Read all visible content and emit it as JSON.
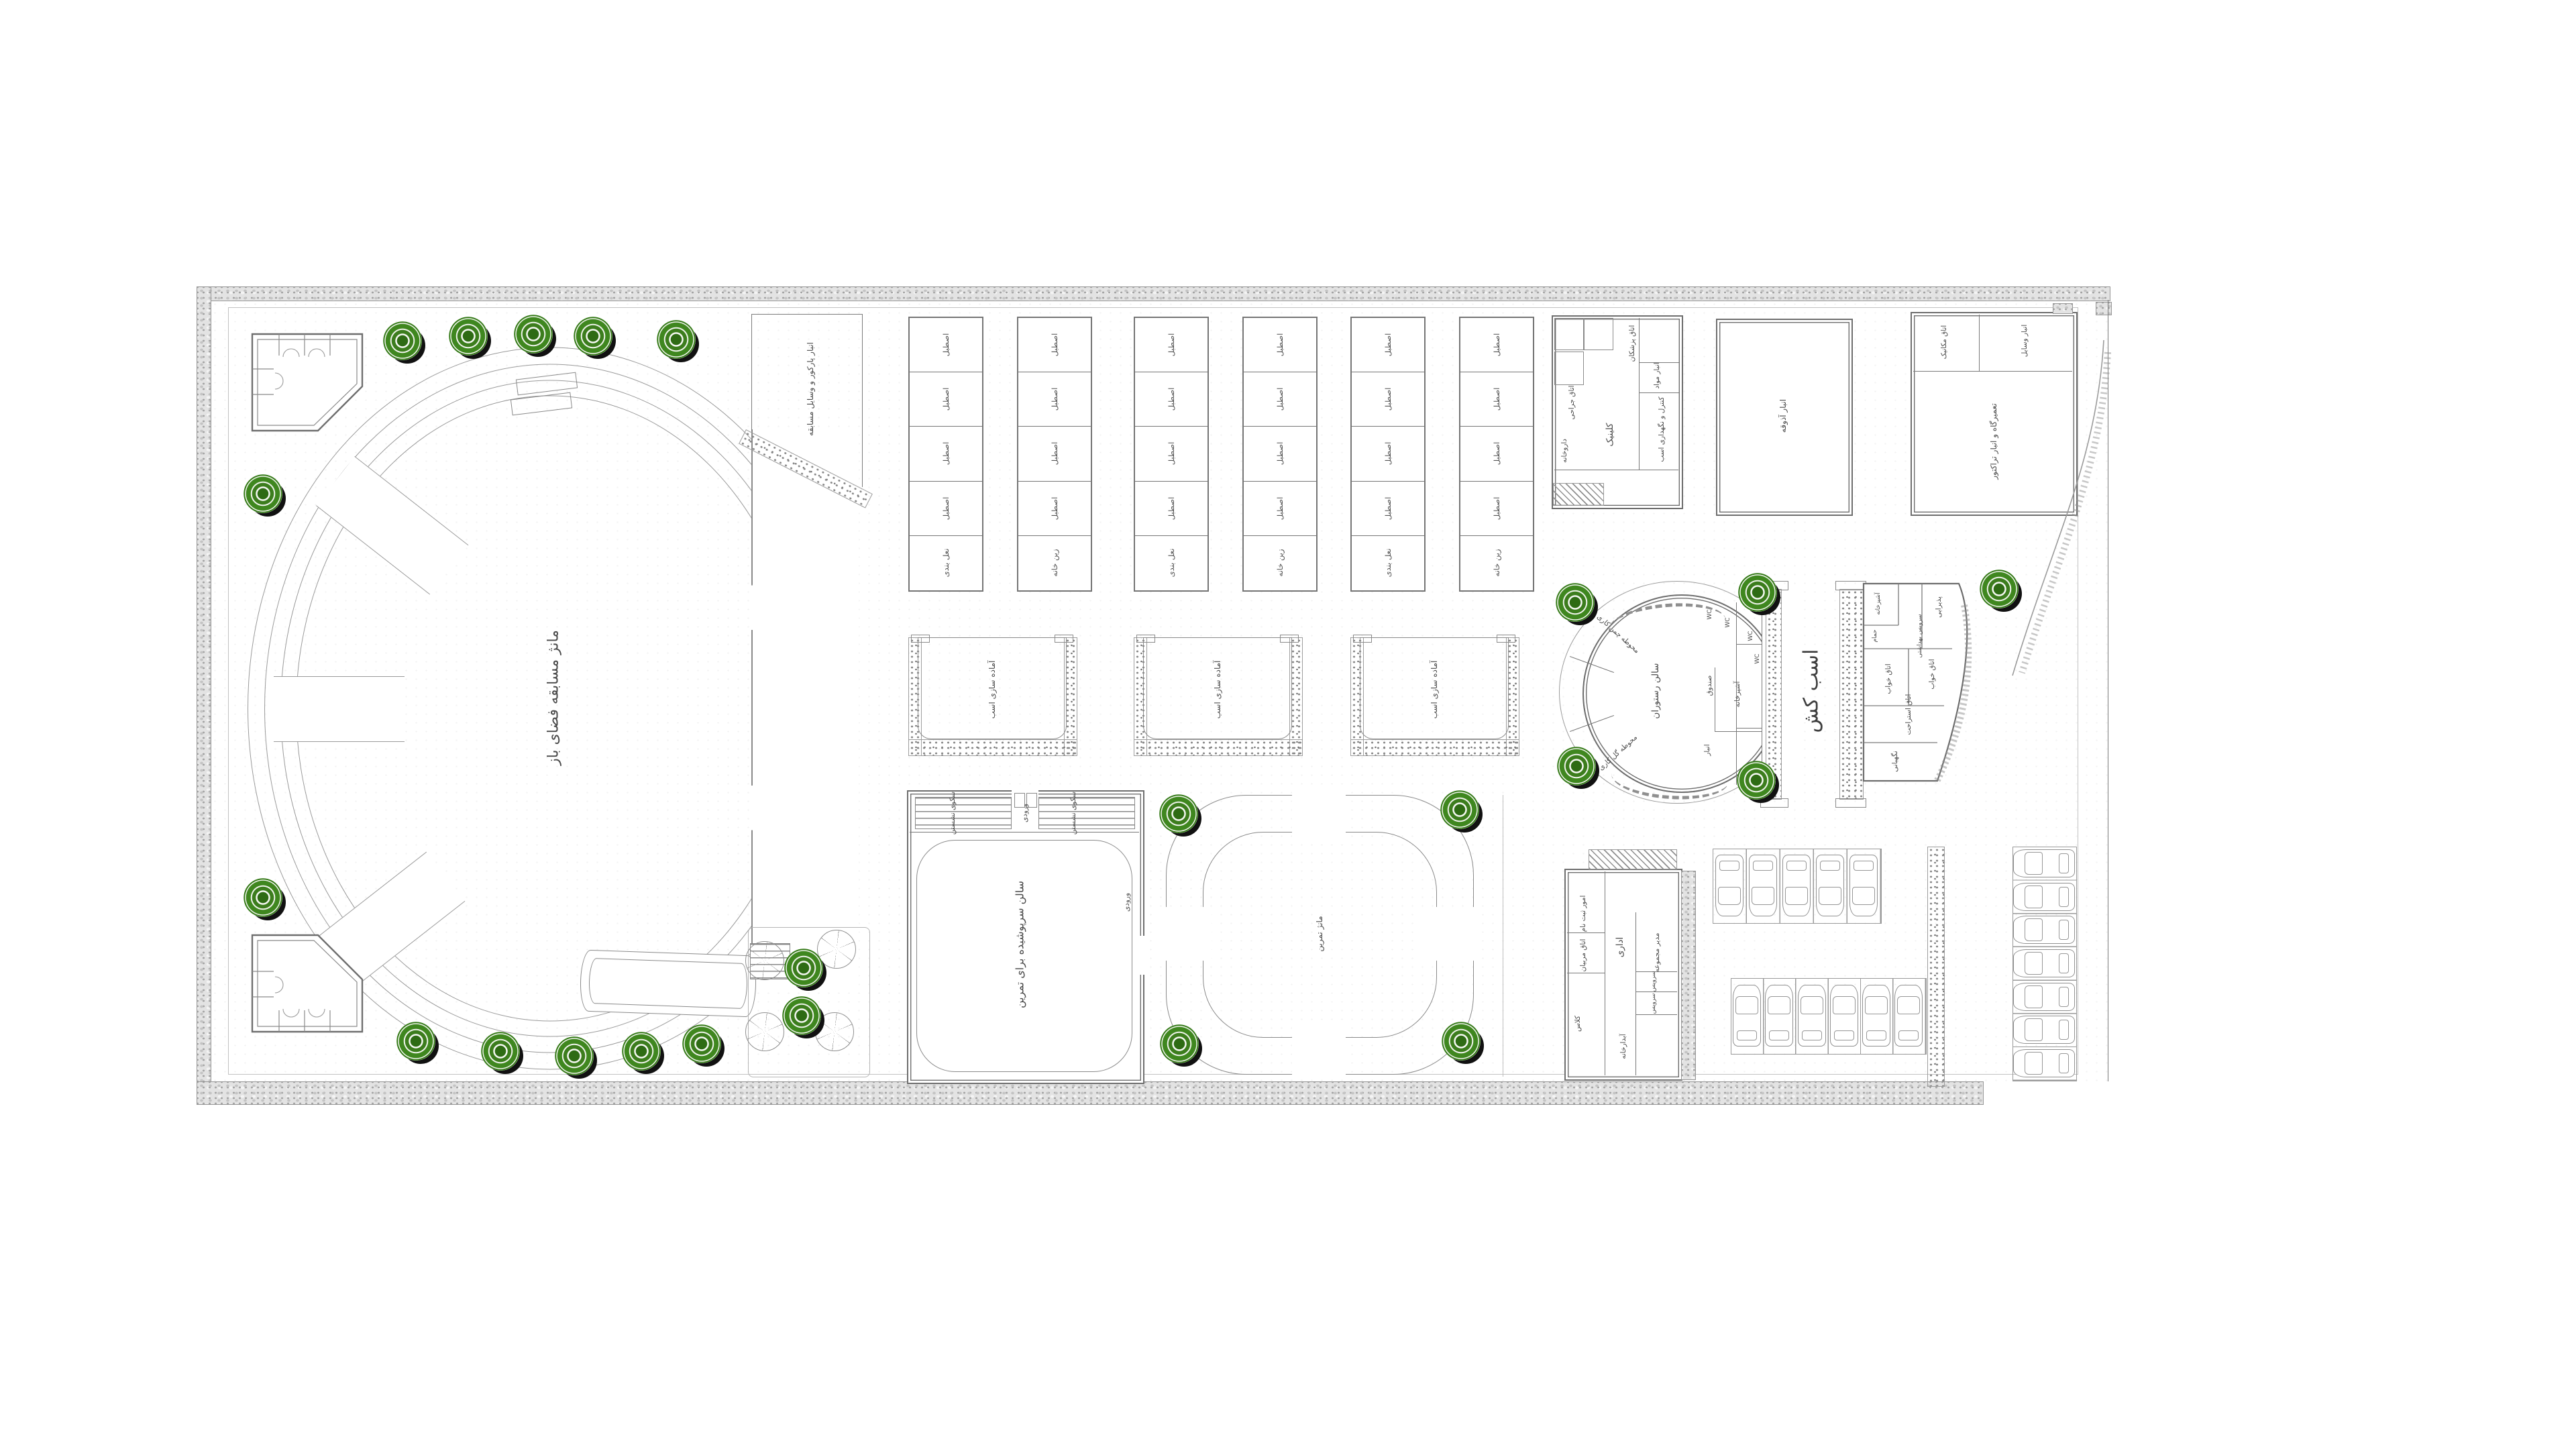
{
  "colors": {
    "tree": "#3b7d1c",
    "tree_shadow": "#111111",
    "wall": "#6e6e6e",
    "line": "#8a8a8a",
    "gravel": "#e3e3e3",
    "text": "#4a4a4a",
    "background": "#ffffff"
  },
  "plan": {
    "stadium": {
      "label": "مانژ مسابقه فضای باز"
    },
    "obstacle_store": {
      "label": "انبار پارکور و وسایل مسابقه"
    },
    "stables": {
      "blocks": 3,
      "left_labels": [
        "اصطبل",
        "اصطبل",
        "اصطبل",
        "اصطبل",
        "نعل بندی"
      ],
      "right_labels": [
        "اصطبل",
        "اصطبل",
        "اصطبل",
        "اصطبل",
        "زین خانه"
      ]
    },
    "paddocks": {
      "count": 3,
      "label": "آماده سازی اسب"
    },
    "hall": {
      "label": "سالن سرپوشیده برای تمرین",
      "entrance": "ورودی",
      "seating": "سکوی نشستن"
    },
    "ring": {
      "label": "مانژ تمرین"
    },
    "clinic": {
      "name": "کلینیک",
      "rooms": [
        "اتاق جراحی",
        "داروخانه",
        "اتاق پزشکان",
        "انبار مواد",
        "کنترل و نگهداری اسب"
      ]
    },
    "feed": {
      "label": "انبار آذوقه"
    },
    "workshop": {
      "label": "تعمیرگاه و انبار تراکتور",
      "rooms": [
        "اتاق مکانیک",
        "انبار وسایل"
      ]
    },
    "restaurant": {
      "hall": "سالن رستوران",
      "kitchen": "آشپزخانه",
      "cashier": "صندوق",
      "store": "انبار",
      "wc": "WC",
      "lawn_top": "محوطه چمن کاری",
      "lawn_bottom": "محوطه گل کاری"
    },
    "lane": {
      "label": "اسب کش"
    },
    "house": {
      "rooms": [
        "پذیرایی",
        "آشپزخانه",
        "حمام",
        "سرویس بهداشتی",
        "اتاق خواب",
        "اتاق خواب",
        "اتاق استراحت",
        "نگهبانی"
      ]
    },
    "admin": {
      "name": "اداری",
      "rooms": [
        "امور ثبت نام",
        "اتاق مربیان",
        "کلاس",
        "مدیر مجموعه",
        "سرویس",
        "آبدارخانه"
      ]
    }
  },
  "counts": {
    "trees": 21,
    "parasols": 4,
    "cars_top_row": 5,
    "cars_bottom_row": 6,
    "cars_right_column": 7
  }
}
